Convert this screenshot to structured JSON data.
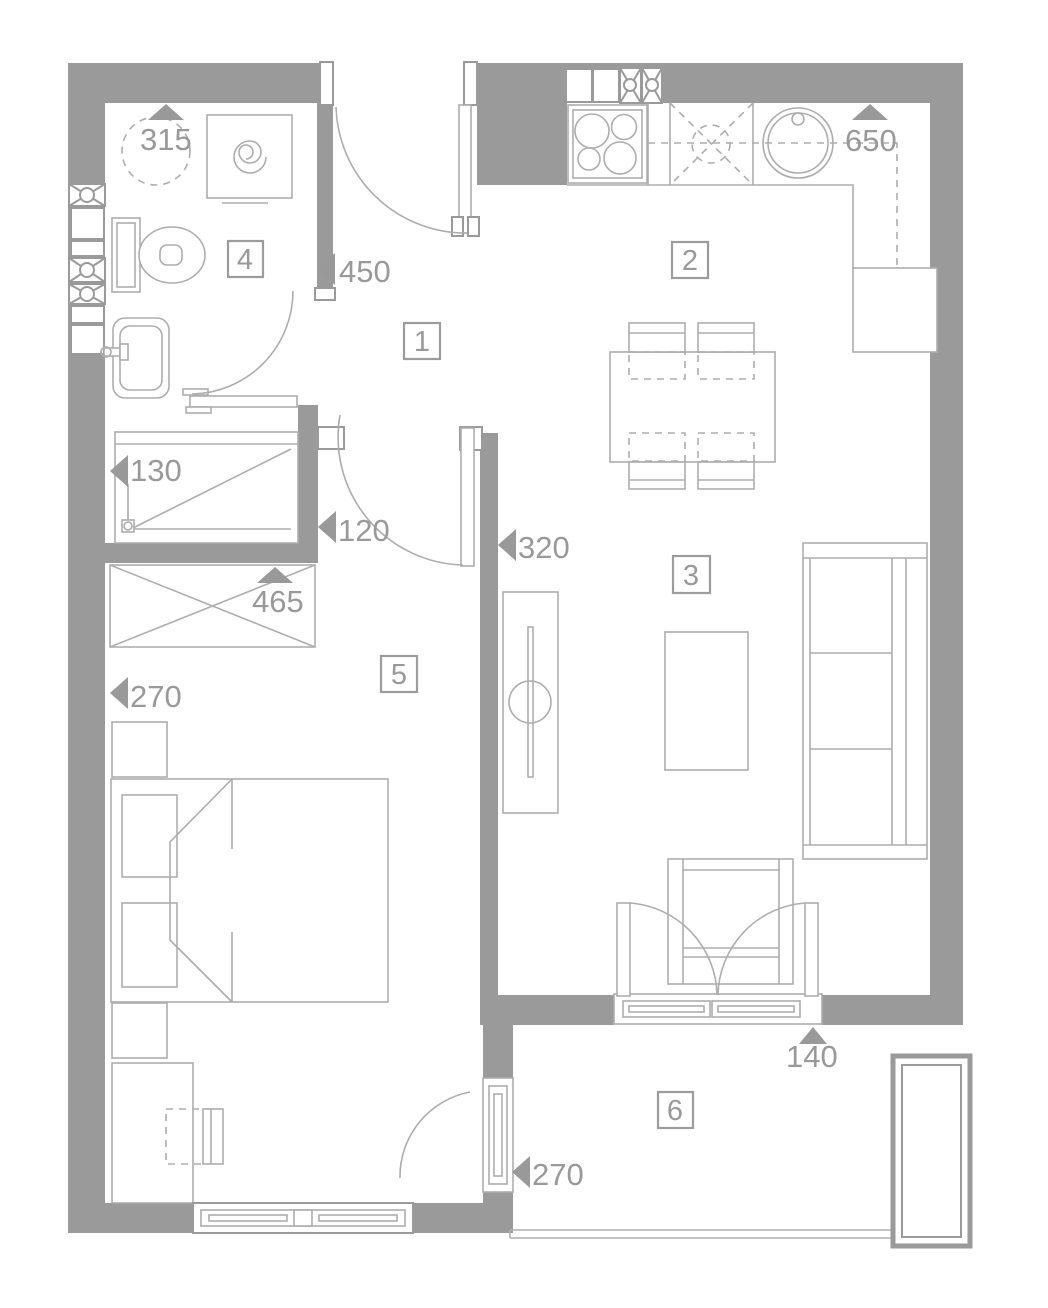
{
  "colors": {
    "wall": "#9a9a9a",
    "furniture_line": "#adadad",
    "label": "#999999",
    "background": "#ffffff"
  },
  "rooms": [
    {
      "number": "1"
    },
    {
      "number": "2"
    },
    {
      "number": "3"
    },
    {
      "number": "4"
    },
    {
      "number": "5"
    },
    {
      "number": "6"
    }
  ],
  "dimensions": [
    {
      "value": "315",
      "arrow": "up"
    },
    {
      "value": "450",
      "arrow": "left"
    },
    {
      "value": "650",
      "arrow": "up"
    },
    {
      "value": "130",
      "arrow": "left"
    },
    {
      "value": "120",
      "arrow": "left"
    },
    {
      "value": "320",
      "arrow": "left"
    },
    {
      "value": "465",
      "arrow": "up"
    },
    {
      "value": "270",
      "arrow": "left"
    },
    {
      "value": "140",
      "arrow": "up"
    },
    {
      "value": "270",
      "arrow": "left"
    }
  ],
  "symbols": [
    "boiler",
    "washing-machine",
    "toilet",
    "washbasin",
    "shower",
    "wardrobe",
    "installation-shaft",
    "stove",
    "kitchen-counter",
    "kitchen-sink",
    "fridge",
    "dining-table",
    "dining-chair",
    "tv-cabinet",
    "coffee-table",
    "sofa",
    "armchair",
    "bed",
    "nightstand",
    "desk",
    "desk-chair",
    "window",
    "balcony-door",
    "entrance-door",
    "balcony-planter",
    "balcony-railing"
  ]
}
